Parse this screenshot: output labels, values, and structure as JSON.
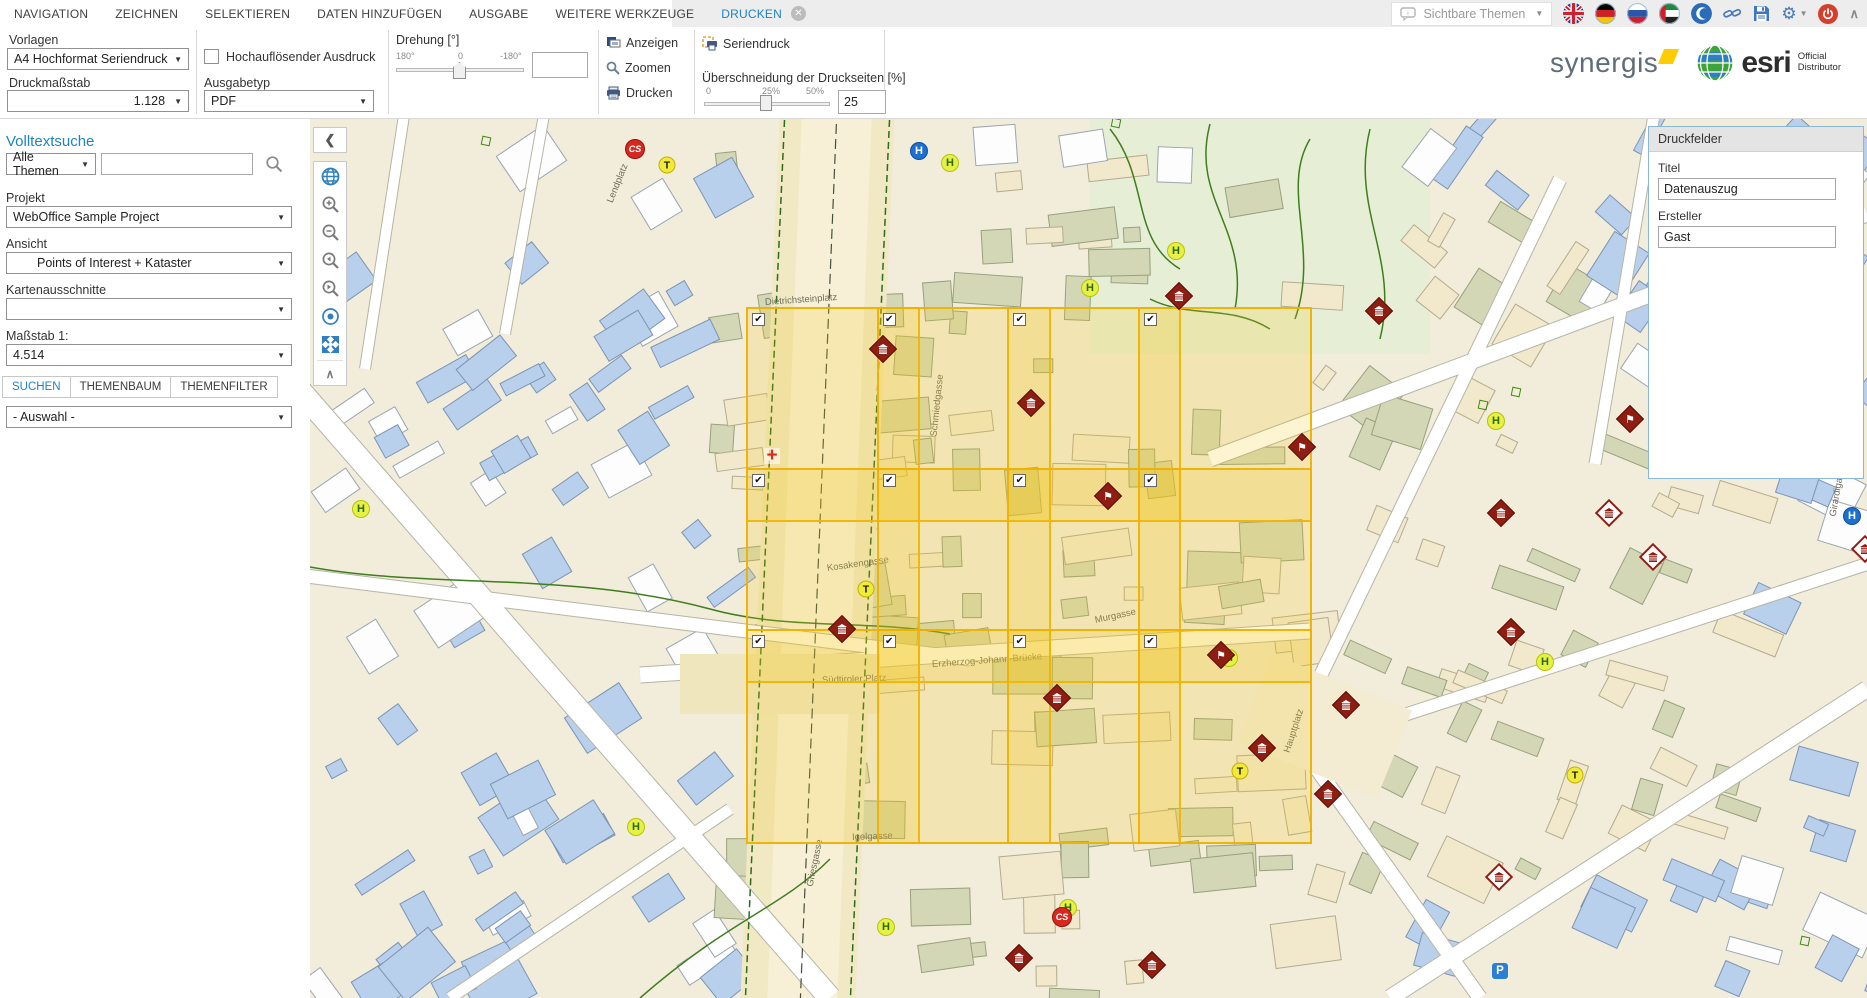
{
  "app": {
    "accent": "#1f83c3",
    "grid_yellow": "#eeb100",
    "marker_maroon": "#8e1d12"
  },
  "menu": {
    "items": [
      {
        "id": "navigation",
        "label": "NAVIGATION",
        "active": false
      },
      {
        "id": "zeichnen",
        "label": "ZEICHNEN",
        "active": false
      },
      {
        "id": "selektieren",
        "label": "SELEKTIEREN",
        "active": false
      },
      {
        "id": "daten-hinzufuegen",
        "label": "DATEN HINZUFÜGEN",
        "active": false
      },
      {
        "id": "ausgabe",
        "label": "AUSGABE",
        "active": false
      },
      {
        "id": "weitere-werkzeuge",
        "label": "WEITERE WERKZEUGE",
        "active": false
      },
      {
        "id": "drucken",
        "label": "DRUCKEN",
        "active": true,
        "closable": true
      }
    ],
    "close_glyph": "✕"
  },
  "topbar_right": {
    "sichtbare_themen_label": "Sichtbare Themen",
    "icon_names": [
      "info-bubble-icon",
      "flag-uk-icon",
      "flag-de-icon",
      "flag-ru-icon",
      "flag-ae-icon",
      "crescent-icon",
      "link-icon",
      "save-icon",
      "gear-icon",
      "power-icon",
      "collapse-up-icon"
    ]
  },
  "branding": {
    "synergis": "synergis",
    "esri": "esri",
    "esri_official": "Official",
    "esri_distributor": "Distributor"
  },
  "toolbar": {
    "vorlagen": {
      "label": "Vorlagen",
      "value": "A4 Hochformat Seriendruck"
    },
    "druckmassstab": {
      "label": "Druckmaßstab",
      "value": "1.128"
    },
    "hochaufloesend": {
      "label": "Hochauflösender Ausdruck",
      "checked": false
    },
    "ausgabetyp": {
      "label": "Ausgabetyp",
      "value": "PDF"
    },
    "drehung": {
      "label": "Drehung [°]",
      "tick_left": "180°",
      "tick_mid": "0",
      "tick_right": "-180°",
      "value": ""
    },
    "anzeigen_label": "Anzeigen",
    "zoomen_label": "Zoomen",
    "drucken_label": "Drucken",
    "seriendruck_label": "Seriendruck",
    "ueberschneidung": {
      "label": "Überschneidung der Druckseiten [%]",
      "tick_left": "0",
      "tick_mid": "25%",
      "tick_right": "50%",
      "value": "25"
    }
  },
  "sidebar": {
    "volltextsuche": "Volltextsuche",
    "themen_select_value": "Alle Themen",
    "search_value": "",
    "projekt": {
      "label": "Projekt",
      "value": "WebOffice Sample Project"
    },
    "ansicht": {
      "label": "Ansicht",
      "value": "Points of Interest + Kataster"
    },
    "kartenausschnitte": {
      "label": "Kartenausschnitte",
      "value": ""
    },
    "massstab": {
      "label": "Maßstab 1:",
      "value": "4.514"
    },
    "tabs": [
      {
        "id": "suchen",
        "label": "SUCHEN",
        "active": true
      },
      {
        "id": "themenbaum",
        "label": "THEMENBAUM",
        "active": false
      },
      {
        "id": "themenfilter",
        "label": "THEMENFILTER",
        "active": false
      }
    ],
    "auswahl_select_value": "- Auswahl -"
  },
  "druckfelder": {
    "header": "Druckfelder",
    "titel_label": "Titel",
    "titel_value": "Datenauszug",
    "ersteller_label": "Ersteller",
    "ersteller_value": "Gast"
  },
  "map": {
    "print_grid": {
      "left": 436,
      "top": 188,
      "cols": 4,
      "rows": 3,
      "page_width": 174,
      "page_height": 215,
      "step_x": 130.67,
      "step_y": 161,
      "all_checked": true,
      "check_glyph": "✔"
    },
    "markers": [
      {
        "type": "stop-blue",
        "x": 609,
        "y": 32,
        "glyph": "H"
      },
      {
        "type": "stop-yellow",
        "x": 640,
        "y": 44,
        "glyph": "H"
      },
      {
        "type": "stop-yellow",
        "x": 866,
        "y": 132,
        "glyph": "H"
      },
      {
        "type": "stop-yellow",
        "x": 780,
        "y": 169,
        "glyph": "H"
      },
      {
        "type": "stop-yellow",
        "x": 1186,
        "y": 302,
        "glyph": "H"
      },
      {
        "type": "stop-yellow",
        "x": 51,
        "y": 390,
        "glyph": "H"
      },
      {
        "type": "stop-yellow",
        "x": 919,
        "y": 539,
        "glyph": "H"
      },
      {
        "type": "stop-yellow",
        "x": 1235,
        "y": 543,
        "glyph": "H"
      },
      {
        "type": "stop-yellow",
        "x": 326,
        "y": 708,
        "glyph": "H"
      },
      {
        "type": "stop-yellow",
        "x": 576,
        "y": 808,
        "glyph": "H"
      },
      {
        "type": "stop-yellow",
        "x": 758,
        "y": 789,
        "glyph": "H"
      },
      {
        "type": "stop-blue",
        "x": 1542,
        "y": 397,
        "glyph": "H"
      },
      {
        "type": "taxi",
        "x": 357,
        "y": 46,
        "glyph": "T"
      },
      {
        "type": "taxi",
        "x": 556,
        "y": 470,
        "glyph": "T"
      },
      {
        "type": "taxi",
        "x": 930,
        "y": 652,
        "glyph": "T"
      },
      {
        "type": "taxi",
        "x": 1265,
        "y": 656,
        "glyph": "T"
      },
      {
        "type": "cs",
        "x": 325,
        "y": 30,
        "glyph": "CS"
      },
      {
        "type": "cs",
        "x": 752,
        "y": 798,
        "glyph": "CS"
      },
      {
        "type": "cross",
        "x": 462,
        "y": 337,
        "glyph": "+"
      },
      {
        "type": "parking",
        "x": 1190,
        "y": 852,
        "glyph": "P"
      },
      {
        "type": "diamond",
        "variant": "solid",
        "glyph": "museum",
        "x": 573,
        "y": 230
      },
      {
        "type": "diamond",
        "variant": "solid",
        "glyph": "museum",
        "x": 721,
        "y": 284
      },
      {
        "type": "diamond",
        "variant": "solid",
        "glyph": "museum",
        "x": 869,
        "y": 177
      },
      {
        "type": "diamond",
        "variant": "solid",
        "glyph": "flag",
        "x": 992,
        "y": 328
      },
      {
        "type": "diamond",
        "variant": "solid",
        "glyph": "flag",
        "x": 798,
        "y": 377
      },
      {
        "type": "diamond",
        "variant": "solid",
        "glyph": "flag",
        "x": 911,
        "y": 536
      },
      {
        "type": "diamond",
        "variant": "solid",
        "glyph": "museum",
        "x": 532,
        "y": 510
      },
      {
        "type": "diamond",
        "variant": "solid",
        "glyph": "museum",
        "x": 747,
        "y": 579
      },
      {
        "type": "diamond",
        "variant": "solid",
        "glyph": "museum",
        "x": 952,
        "y": 629
      },
      {
        "type": "diamond",
        "variant": "solid",
        "glyph": "museum",
        "x": 1069,
        "y": 192
      },
      {
        "type": "diamond",
        "variant": "solid",
        "glyph": "flag",
        "x": 1320,
        "y": 300
      },
      {
        "type": "diamond",
        "variant": "solid",
        "glyph": "museum",
        "x": 1191,
        "y": 394
      },
      {
        "type": "diamond",
        "variant": "solid",
        "glyph": "museum",
        "x": 1201,
        "y": 513
      },
      {
        "type": "diamond",
        "variant": "solid",
        "glyph": "museum",
        "x": 1036,
        "y": 586
      },
      {
        "type": "diamond",
        "variant": "solid",
        "glyph": "museum",
        "x": 1018,
        "y": 675
      },
      {
        "type": "diamond",
        "variant": "solid",
        "glyph": "museum",
        "x": 842,
        "y": 846
      },
      {
        "type": "diamond",
        "variant": "solid",
        "glyph": "museum",
        "x": 709,
        "y": 839
      },
      {
        "type": "diamond",
        "variant": "outline",
        "glyph": "museum",
        "x": 1299,
        "y": 394
      },
      {
        "type": "diamond",
        "variant": "outline",
        "glyph": "museum",
        "x": 1343,
        "y": 438
      },
      {
        "type": "diamond",
        "variant": "outline",
        "glyph": "museum",
        "x": 1189,
        "y": 758
      },
      {
        "type": "diamond",
        "variant": "outline",
        "glyph": "museum",
        "x": 1555,
        "y": 430
      },
      {
        "type": "diamond",
        "variant": "outline",
        "glyph": "museum",
        "x": 1520,
        "y": 100
      },
      {
        "type": "green-square",
        "x": 176,
        "y": 22
      },
      {
        "type": "green-square",
        "x": 806,
        "y": 4
      },
      {
        "type": "green-square",
        "x": 1173,
        "y": 286
      },
      {
        "type": "green-square",
        "x": 1206,
        "y": 273
      },
      {
        "type": "green-square",
        "x": 1495,
        "y": 822
      }
    ],
    "street_labels": [
      {
        "text": "Dietrichsteinplatz",
        "x": 455,
        "y": 178,
        "rot": -4
      },
      {
        "text": "Kosakengasse",
        "x": 517,
        "y": 444,
        "rot": -8
      },
      {
        "text": "Igelgasse",
        "x": 542,
        "y": 713,
        "rot": -2
      },
      {
        "text": "Griesgasse",
        "x": 500,
        "y": 762,
        "rot": -78
      },
      {
        "text": "Südtiroler Platz",
        "x": 512,
        "y": 556,
        "rot": -2
      },
      {
        "text": "Erzherzog-Johann-Brücke",
        "x": 622,
        "y": 540,
        "rot": -4
      },
      {
        "text": "Murgasse",
        "x": 785,
        "y": 496,
        "rot": -12
      },
      {
        "text": "Hauptplatz",
        "x": 977,
        "y": 628,
        "rot": -72
      },
      {
        "text": "Schmiedgasse",
        "x": 624,
        "y": 312,
        "rot": -84
      },
      {
        "text": "Lendplatz",
        "x": 300,
        "y": 78,
        "rot": -68
      },
      {
        "text": "Girardigasse",
        "x": 1523,
        "y": 392,
        "rot": -80
      }
    ]
  }
}
